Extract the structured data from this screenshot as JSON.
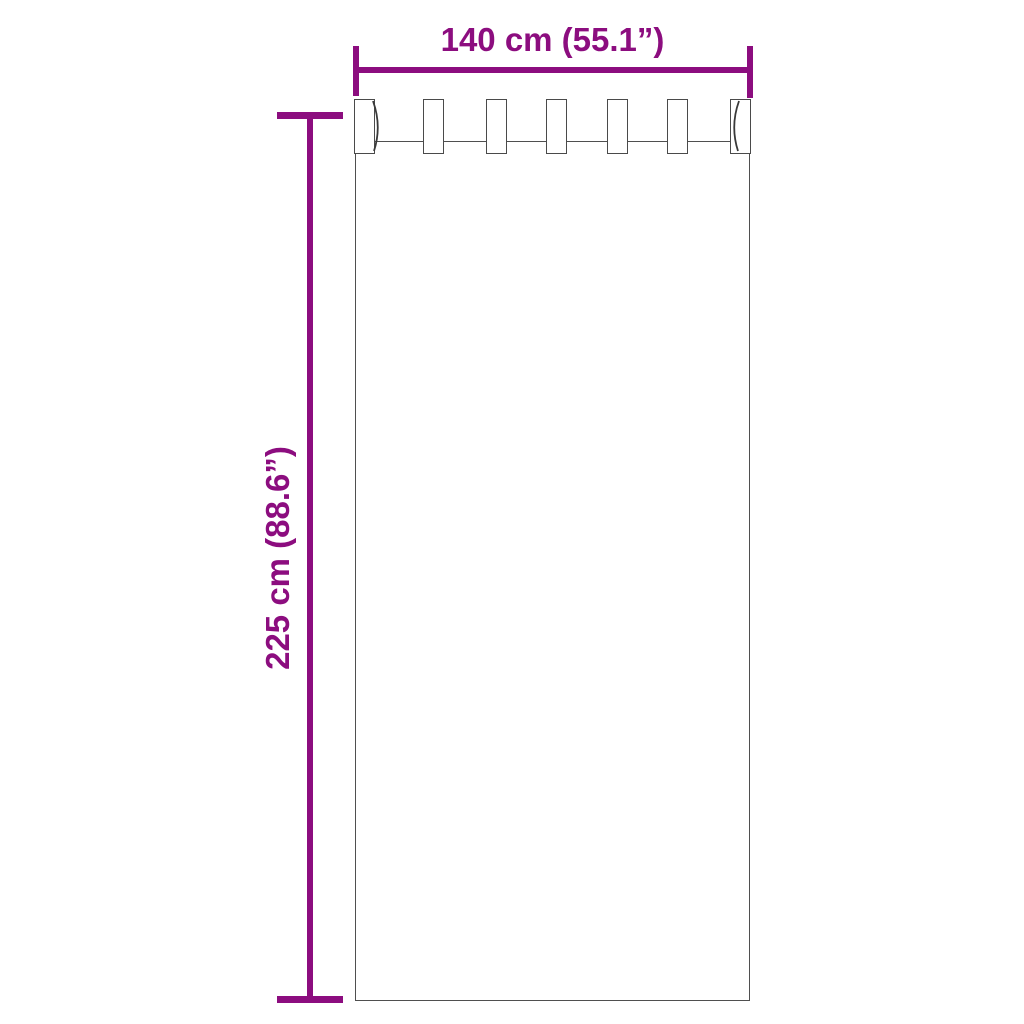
{
  "diagram": {
    "type": "product-dimension-diagram",
    "subject": "tab-top curtain outline",
    "width_label": "140 cm (55.1”)",
    "height_label": "225 cm (88.6”)",
    "tabs_count": 7,
    "accent_color": "#8C0D7F",
    "outline_color": "#4F4F4F",
    "background_color": "#FFFFFF"
  }
}
